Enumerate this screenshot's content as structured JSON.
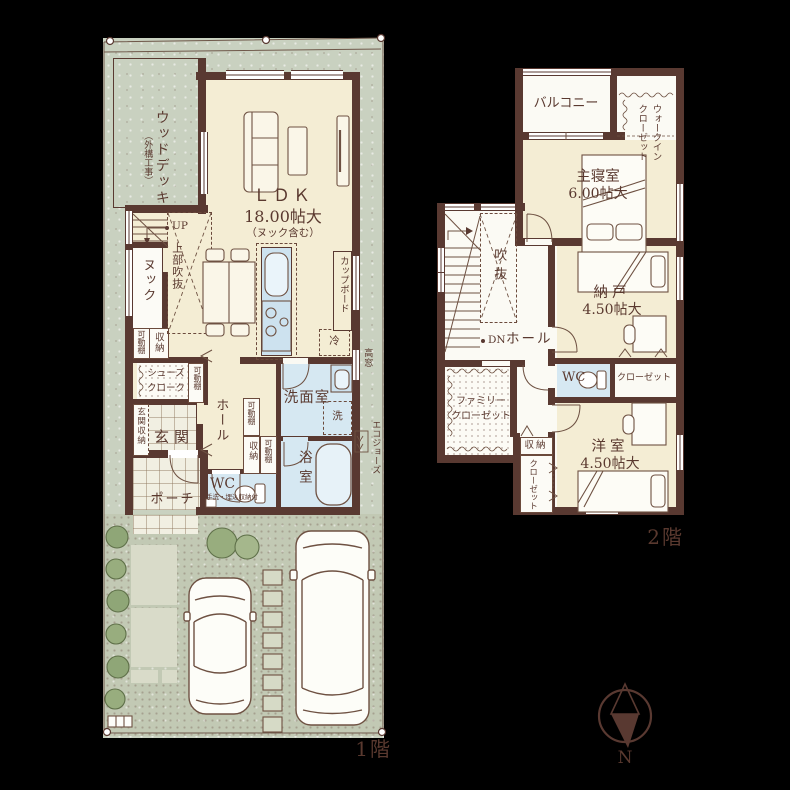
{
  "colors": {
    "wall": "#593931",
    "room_cream": "#f4edd4",
    "wet_blue": "#d6e8f2",
    "site_green": "#c9d1c0",
    "text_brown": "#5a392f"
  },
  "floor1": {
    "label": "1階",
    "wood_deck": "ウッドデッキ",
    "wood_deck_note": "（外構工事）",
    "ldk": "ＬＤＫ",
    "ldk_size": "18.00帖大",
    "ldk_note": "（ヌック含む）",
    "up": "UP",
    "upper_void": "上部吹抜",
    "nook": "ヌック",
    "shelf_a": "可動棚",
    "storage_a": "収納",
    "cupboard": "カップボード",
    "fridge": "冷",
    "shoes_closet_l1": "シューズ",
    "shoes_closet_l2": "クローク",
    "shelf_b": "可動棚",
    "entrance_storage": "玄関収納",
    "entrance": "玄関",
    "porch": "ポーチ",
    "hall": "ホール",
    "shelf_c": "可動棚",
    "storage_b": "収納",
    "shelf_d": "可動棚",
    "wc": "WC",
    "wc_note": "手洗・埋込収納付",
    "washroom": "洗面室",
    "washer": "洗",
    "bathroom": "浴室",
    "high_window": "高窓",
    "eco_boiler": "エコジョーズ"
  },
  "floor2": {
    "label": "2階",
    "balcony": "バルコニー",
    "wic_l1": "ウォークイン",
    "wic_l2": "クローゼット",
    "master_bedroom": "主寝室",
    "master_size": "6.00帖大",
    "void": "吹抜",
    "dn": "DN",
    "hall": "ホール",
    "storage_room": "納戸",
    "storage_room_size": "4.50帖大",
    "wc": "WC",
    "closet_a": "クローゼット",
    "family_closet_l1": "ファミリー",
    "family_closet_l2": "クローゼット",
    "storage": "収納",
    "closet_b": "クローゼット",
    "western_room": "洋室",
    "western_room_size": "4.50帖大"
  },
  "compass": {
    "north": "N"
  }
}
